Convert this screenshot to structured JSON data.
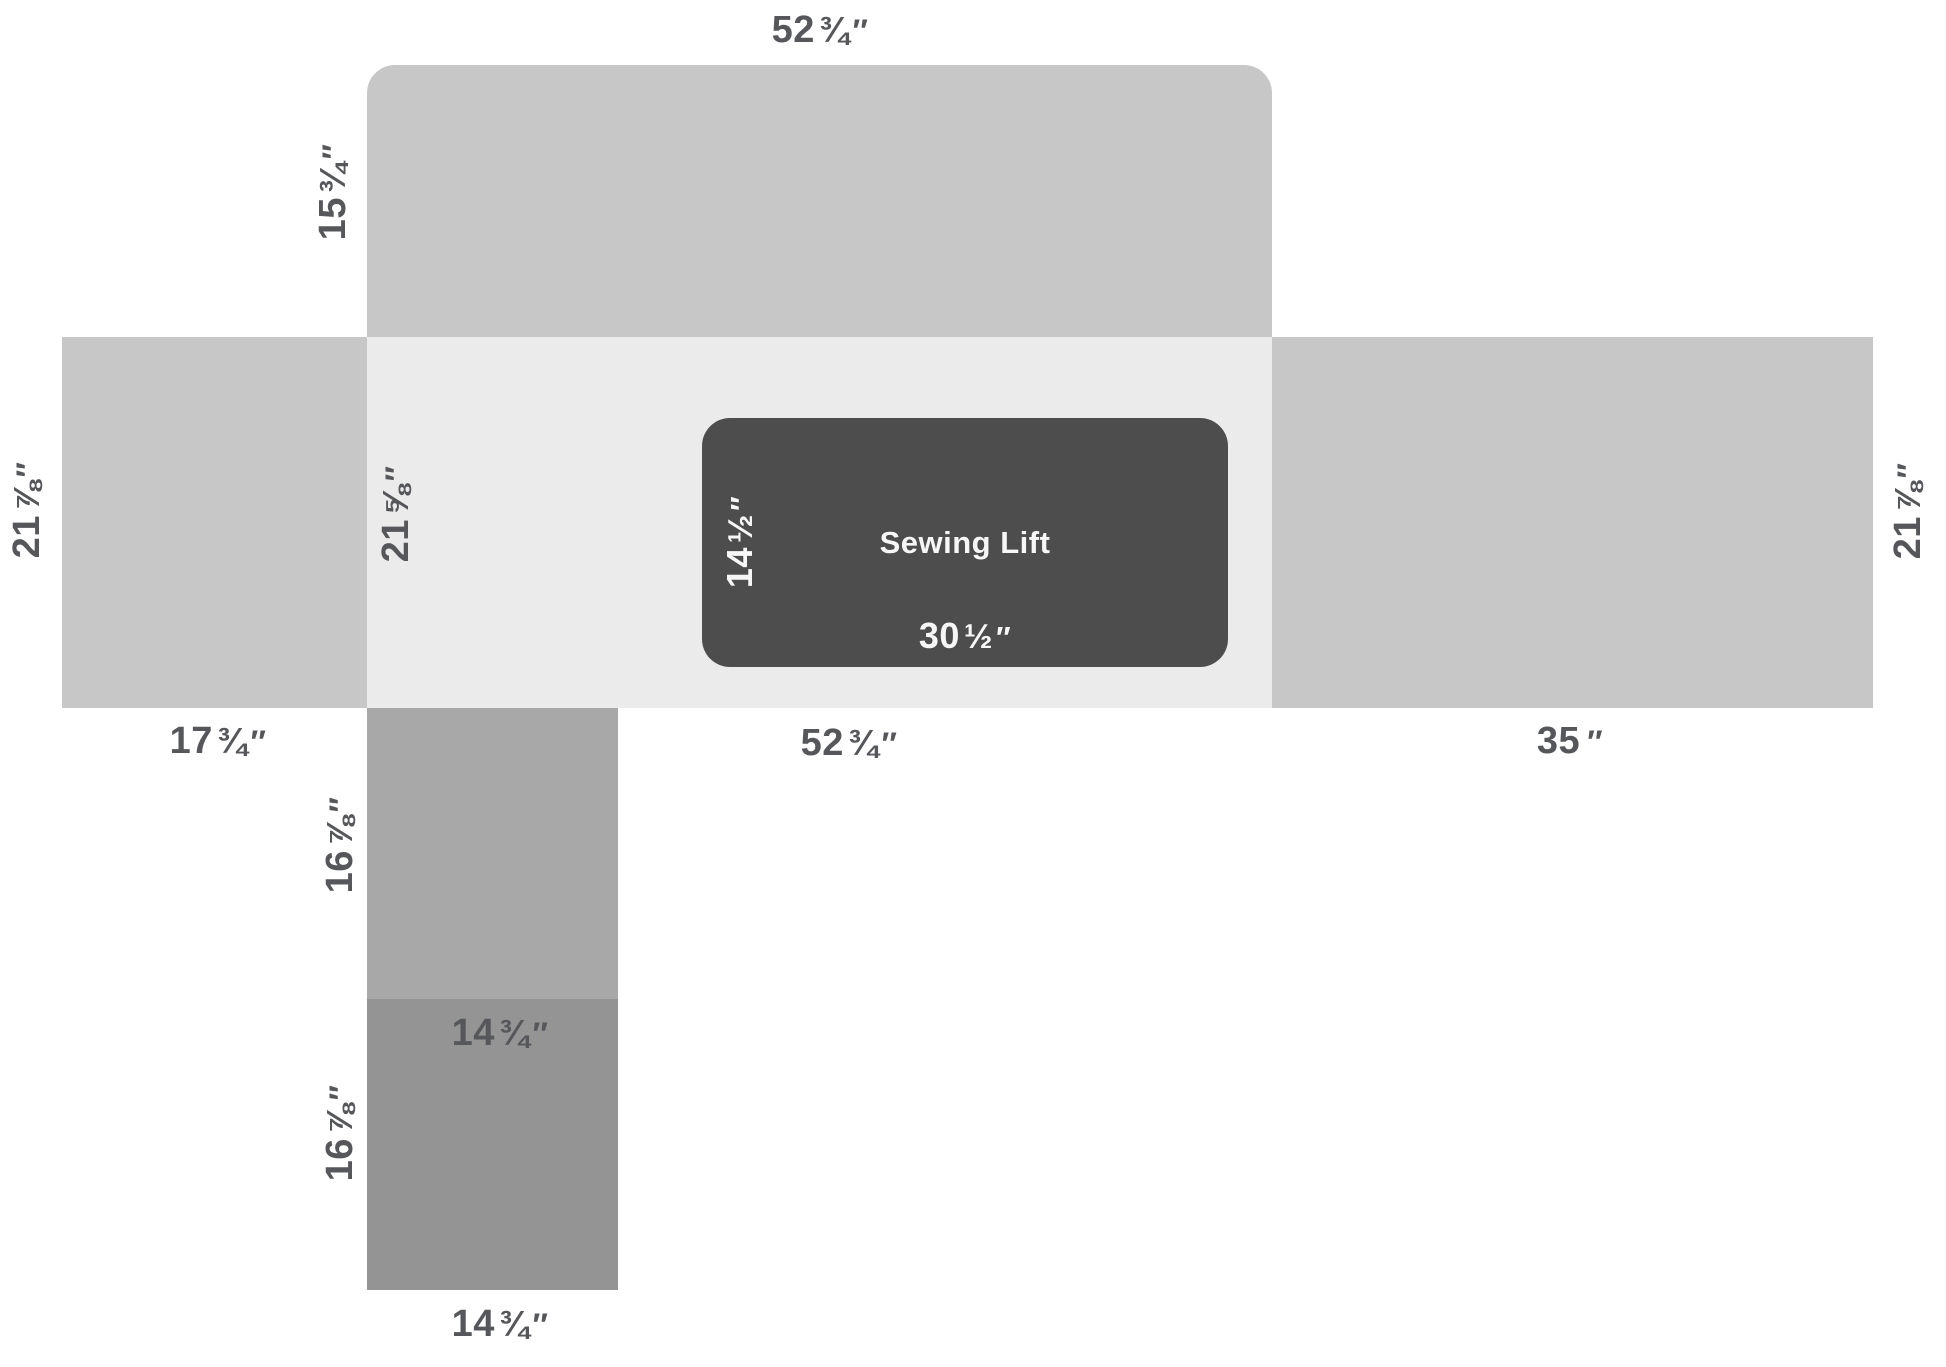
{
  "colors": {
    "panel_gray": "#c7c7c7",
    "counter_pale": "#ebebeb",
    "lift_dark": "#4d4d4d",
    "cabinet_upper_gray": "#a8a8a8",
    "cabinet_lower_gray": "#949494",
    "label_text": "#56575b",
    "label_text_on_dark": "#f7f7f7"
  },
  "lift": {
    "name": "Sewing Lift"
  },
  "dims": {
    "top_panel_width": {
      "main": "52",
      "frac": "¾",
      "unit": "″"
    },
    "top_panel_height": {
      "main": "15",
      "frac": "¾",
      "unit": "″"
    },
    "counter_left_depth": {
      "main": "21",
      "frac": "⅞",
      "unit": "″"
    },
    "counter_center_depth": {
      "main": "21",
      "frac": "⅝",
      "unit": "″"
    },
    "counter_right_depth": {
      "main": "21",
      "frac": "⅞",
      "unit": "″"
    },
    "lift_depth": {
      "main": "14",
      "frac": "½",
      "unit": "″"
    },
    "lift_width": {
      "main": "30",
      "frac": "½",
      "unit": "″"
    },
    "counter_left_width": {
      "main": "17",
      "frac": "¾",
      "unit": "″"
    },
    "counter_center_width": {
      "main": "52",
      "frac": "¾",
      "unit": "″"
    },
    "counter_right_width": {
      "main": "35",
      "frac": "",
      "unit": "″"
    },
    "cabinet_upper_height": {
      "main": "16",
      "frac": "⅞",
      "unit": "″"
    },
    "cabinet_upper_width": {
      "main": "14",
      "frac": "¾",
      "unit": "″"
    },
    "cabinet_lower_height": {
      "main": "16",
      "frac": "⅞",
      "unit": "″"
    },
    "cabinet_lower_width": {
      "main": "14",
      "frac": "¾",
      "unit": "″"
    }
  }
}
